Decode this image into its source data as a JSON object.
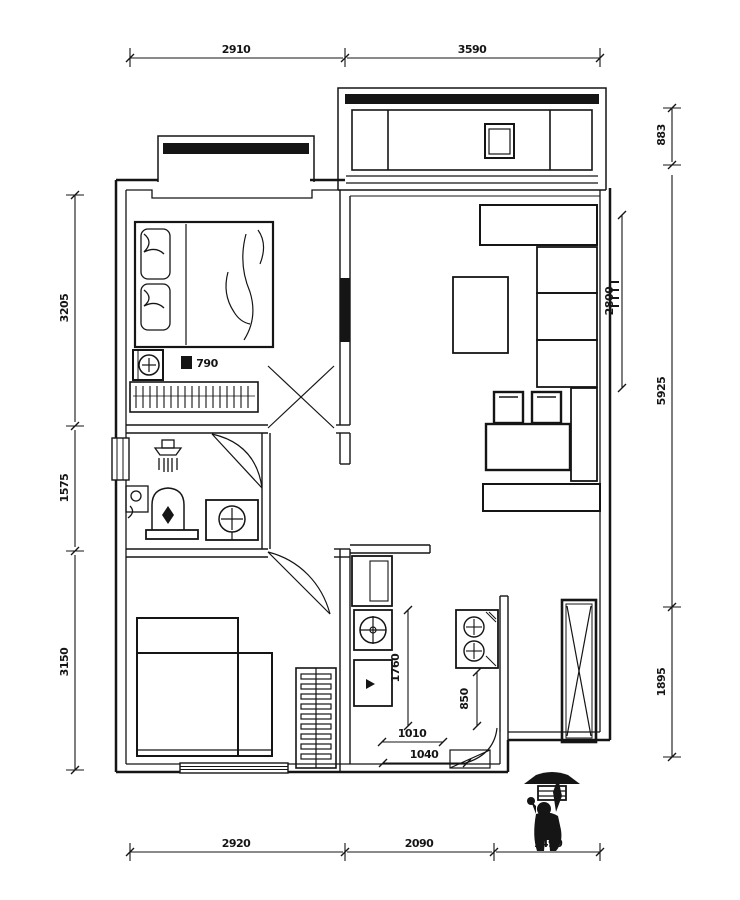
{
  "meta": {
    "type": "architectural-floor-plan",
    "units": "mm"
  },
  "colors": {
    "ink": "#151515",
    "paper": "#ffffff"
  },
  "dims": {
    "top_left": "2910",
    "top_right": "3590",
    "bottom_left": "2920",
    "bottom_mid": "2090",
    "bottom_right": "1490",
    "left_top": "3205",
    "left_mid": "1575",
    "left_bottom": "3150",
    "right_top": "883",
    "right_mid": "5925",
    "right_bottom": "1895",
    "living_depth": "2800",
    "washer_width": "790",
    "kitchen_depth": "1760",
    "cooktop_width": "850",
    "kitchen_inner": "1010",
    "entry_width": "1040"
  },
  "icons": {
    "bed": "double-bed-symbol",
    "wardrobe": "hanging-clothes-hatch",
    "washing_machine": "circle-in-square",
    "shower": "shower-head-symbol",
    "toilet": "toilet-symbol",
    "washbasin": "round-basin-in-counter",
    "sink": "kitchen-sink-circle",
    "cooktop": "two-burner-hob",
    "fridge": "fridge-box",
    "sofa": "sofa-cushions",
    "shaft": "duct-with-cross",
    "scale_figure": "human-silhouette-with-umbrella"
  }
}
